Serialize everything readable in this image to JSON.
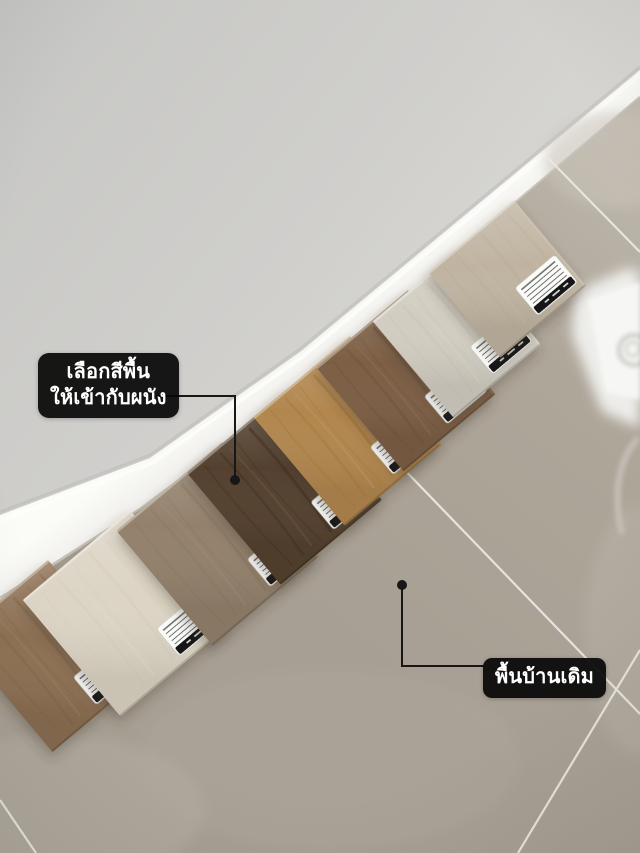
{
  "annotations": {
    "wall_note": {
      "line1": "เลือกสีพื้น",
      "line2": "ให้เข้ากับผนัง"
    },
    "floor_note": {
      "text": "พื้นบ้านเดิม"
    }
  },
  "scene": {
    "colors": {
      "wall": "#cfcecb",
      "baseboard": "#f3f2ee",
      "baseboard_highlight": "#fcfcfa",
      "tile_floor": "#aba397",
      "grout_line": "#eae8e2",
      "reflection": "#f2f2f0",
      "callout_bg": "#0a0a0a",
      "callout_text": "#ffffff",
      "pointer": "#171717",
      "sticker_white": "#fbfbf9",
      "sticker_black": "#161616"
    }
  },
  "samples": [
    {
      "name": "medium-brown-oak",
      "base": "#8e7154",
      "dark": "#74573c",
      "light": "#a58762",
      "grain_strength": 1.0
    },
    {
      "name": "cream-whitewash-oak",
      "base": "#dcd4c4",
      "dark": "#c3baa7",
      "light": "#ece5d6",
      "grain_strength": 0.55
    },
    {
      "name": "taupe-grey-oak",
      "base": "#93816c",
      "dark": "#7a684f",
      "light": "#a6947f",
      "grain_strength": 0.85
    },
    {
      "name": "dark-espresso-walnut",
      "base": "#54412f",
      "dark": "#36281c",
      "light": "#71583f",
      "grain_strength": 1.6
    },
    {
      "name": "honey-golden-oak",
      "base": "#b2874f",
      "dark": "#93691c",
      "light": "#c79d66",
      "grain_strength": 1.1
    },
    {
      "name": "classic-walnut-brown",
      "base": "#7d5f45",
      "dark": "#61462f",
      "light": "#93755a",
      "grain_strength": 1.2
    },
    {
      "name": "light-grey-washed-oak",
      "base": "#d2cdc1",
      "dark": "#b4ada0",
      "light": "#e2ded4",
      "grain_strength": 0.65
    },
    {
      "name": "greige-stone-beige",
      "base": "#c0b4a1",
      "dark": "#a8998a",
      "light": "#cfc5b4",
      "grain_strength": 0.5
    }
  ]
}
